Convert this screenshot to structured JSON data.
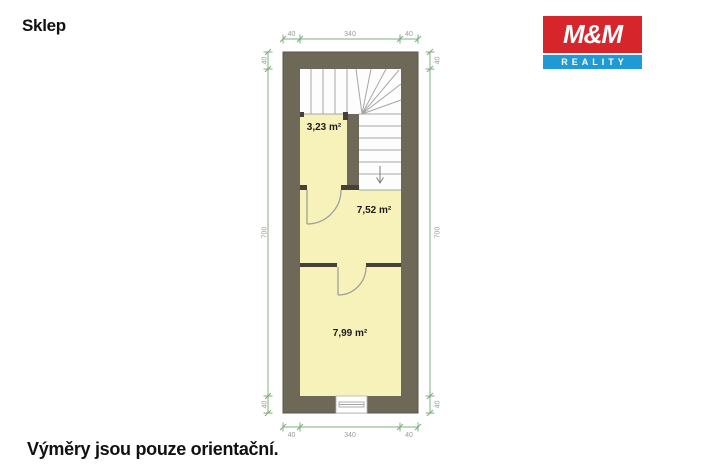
{
  "page": {
    "title": "Sklep",
    "footnote": "Výměry jsou pouze orientační."
  },
  "logo": {
    "top_text": "M&M",
    "bottom_text": "REALITY"
  },
  "plan": {
    "rooms": [
      {
        "id": "room-1",
        "area_label": "3,23 m²"
      },
      {
        "id": "room-2",
        "area_label": "7,52 m²"
      },
      {
        "id": "room-3",
        "area_label": "7,99 m²"
      }
    ],
    "stairs": {
      "direction": "down"
    },
    "dimensions": {
      "top": [
        "40",
        "340",
        "40"
      ],
      "bottom": [
        "40",
        "340",
        "40"
      ],
      "left": [
        "40",
        "700",
        "40"
      ],
      "right": [
        "40",
        "700",
        "40"
      ]
    }
  },
  "colors": {
    "wall": "#6e6859",
    "partition": "#45413a",
    "room_fill": "#f7f2b9",
    "stairs_fill": "#fdfdfd",
    "stair_line": "#a6a6a6",
    "dimension_line": "#7fac7f",
    "dimension_text": "#999999",
    "logo_red": "#d6252b",
    "logo_blue": "#1f9ad6"
  }
}
